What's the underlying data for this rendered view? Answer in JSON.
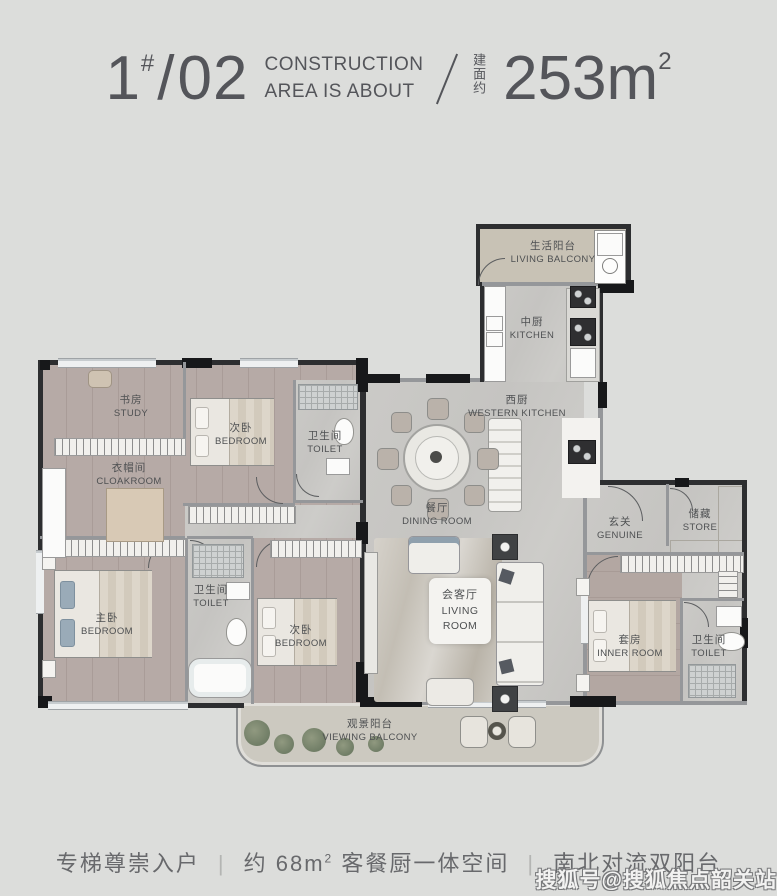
{
  "header": {
    "unit_num": "1",
    "unit_hash": "#",
    "unit_slash": "/",
    "unit_no": "02",
    "line1": "CONSTRUCTION",
    "line2": "AREA IS ABOUT",
    "divider": "/",
    "area_cn": "建面约",
    "area_value": "253m",
    "area_sup": "2"
  },
  "rooms": {
    "living_balcony": {
      "cn": "生活阳台",
      "en": "LIVING BALCONY"
    },
    "kitchen": {
      "cn": "中厨",
      "en": "KITCHEN"
    },
    "western_kitchen": {
      "cn": "西厨",
      "en": "WESTERN KITCHEN"
    },
    "dining": {
      "cn": "餐厅",
      "en": "DINING ROOM"
    },
    "living": {
      "cn": "会客厅",
      "en1": "LIVING",
      "en2": "ROOM"
    },
    "study": {
      "cn": "书房",
      "en": "STUDY"
    },
    "cloakroom": {
      "cn": "衣帽间",
      "en": "CLOAKROOM"
    },
    "bedroom_top": {
      "cn": "次卧",
      "en": "BEDROOM"
    },
    "toilet_top": {
      "cn": "卫生间",
      "en": "TOILET"
    },
    "toilet_mid": {
      "cn": "卫生间",
      "en": "TOILET"
    },
    "master_bedroom": {
      "cn": "主卧",
      "en": "BEDROOM"
    },
    "bedroom_bottom": {
      "cn": "次卧",
      "en": "BEDROOM"
    },
    "entrance": {
      "cn": "玄关",
      "en": "GENUINE"
    },
    "store": {
      "cn": "储藏",
      "en": "STORE"
    },
    "inner_room": {
      "cn": "套房",
      "en": "INNER ROOM"
    },
    "toilet_right": {
      "cn": "卫生间",
      "en": "TOILET"
    },
    "viewing_balcony": {
      "cn": "观景阳台",
      "en": "VIEWING BALCONY"
    }
  },
  "footer": {
    "item1": "专梯尊崇入户",
    "sep": "|",
    "item2_pre": "约 68m",
    "item2_sup": "2",
    "item2_post": " 客餐厨一体空间",
    "item3": "南北对流双阳台"
  },
  "watermark": {
    "text": "搜狐号@搜狐焦点韶关站"
  },
  "colors": {
    "page_bg": "#dcdddb",
    "heading_text": "#54555a",
    "wall_dark": "#2d2e30",
    "wood_floor": "#b6aaa6",
    "stone_floor": "#c9c8c5",
    "balcony_floor": "#ccc9c0",
    "plant_green": "#76846a"
  }
}
